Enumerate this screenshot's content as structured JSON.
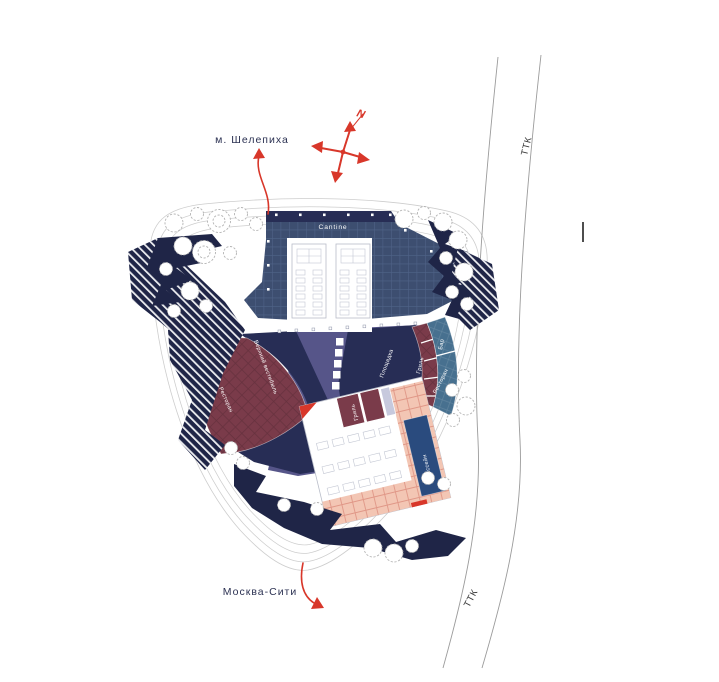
{
  "plan": {
    "context_labels": {
      "metro_station": "м. Шелепиха",
      "moscow_city": "Москва-Сити",
      "ttk_top": "ТТК",
      "ttk_bottom": "ТТК",
      "north": "N"
    },
    "zone_labels": {
      "cantine": "Cantine",
      "upper_vestibule": "Верхний вестибюль",
      "restaurant_west": "Ресторан",
      "playground": "Площадка",
      "grill_arc": "Гриль",
      "bar": "Бар",
      "restaurant_arc": "Ресторан",
      "grill_pavilion": "Гриль",
      "pool": "Бассейн"
    }
  },
  "colors": {
    "navy": "#272d55",
    "rock_navy": "#1f2547",
    "slate_blue": "#3d4e70",
    "slate_grid": "#55698f",
    "indigo": "#565589",
    "maroon": "#7a3b4a",
    "steel_blue": "#47708f",
    "pink": "#f3c6b4",
    "pink_grid": "#e09787",
    "pool_blue": "#2a4b7e",
    "red_accent": "#d8372a",
    "label_navy": "#2b3152",
    "contour_gray": "#cdcdcd",
    "tree_gray": "#b3b3b3",
    "lavender": "#c7c9dd"
  }
}
